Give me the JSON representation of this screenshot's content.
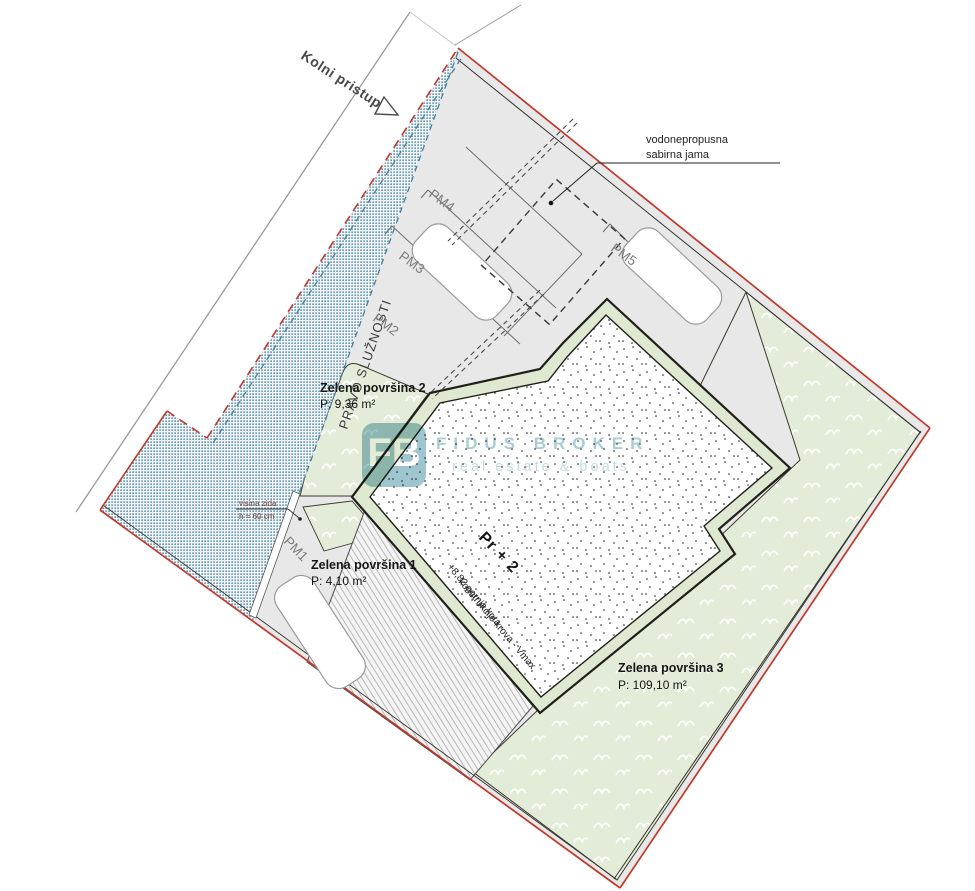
{
  "title": "Situacija - site plan",
  "labels": {
    "kolni_pristup": "Kolni pristup",
    "vodonepropusna_1": "vodonepropusna",
    "vodonepropusna_2": "sabirna jama",
    "pravo_sluznosti": "PRAVO SLUŽNOSTI",
    "pm1": "PM1",
    "pm2": "PM2",
    "pm3": "PM3",
    "pm4": "PM4",
    "pm5": "PM5",
    "zelena1_title": "Zelena površina 1",
    "zelena1_area": "P: 4,10 m²",
    "zelena2_title": "Zelena površina 2",
    "zelena2_area": "P: 9,36 m²",
    "zelena3_title": "Zelena površina 3",
    "zelena3_area": "P: 109,10 m²",
    "visina_1": "visina zida",
    "visina_2": "h = 60 cm",
    "building_title": "Pr + 2",
    "building_sub1": "+8,82 gornja kota",
    "building_sub2": "konstrukcije krova - Vmax"
  },
  "watermark": {
    "logo": "FB",
    "brand": "FIDUS BROKER",
    "tagline": "real estate & boats"
  },
  "colors": {
    "boundary_red": "#c0392b",
    "servitude_blue": "#39789a",
    "paved_gray": "#e8e8e8",
    "green_area": "#e3ecd8",
    "wall_band_green": "#dfe9d2",
    "outline_dark": "#20201a",
    "watermark_teal": "#4f96a6"
  }
}
